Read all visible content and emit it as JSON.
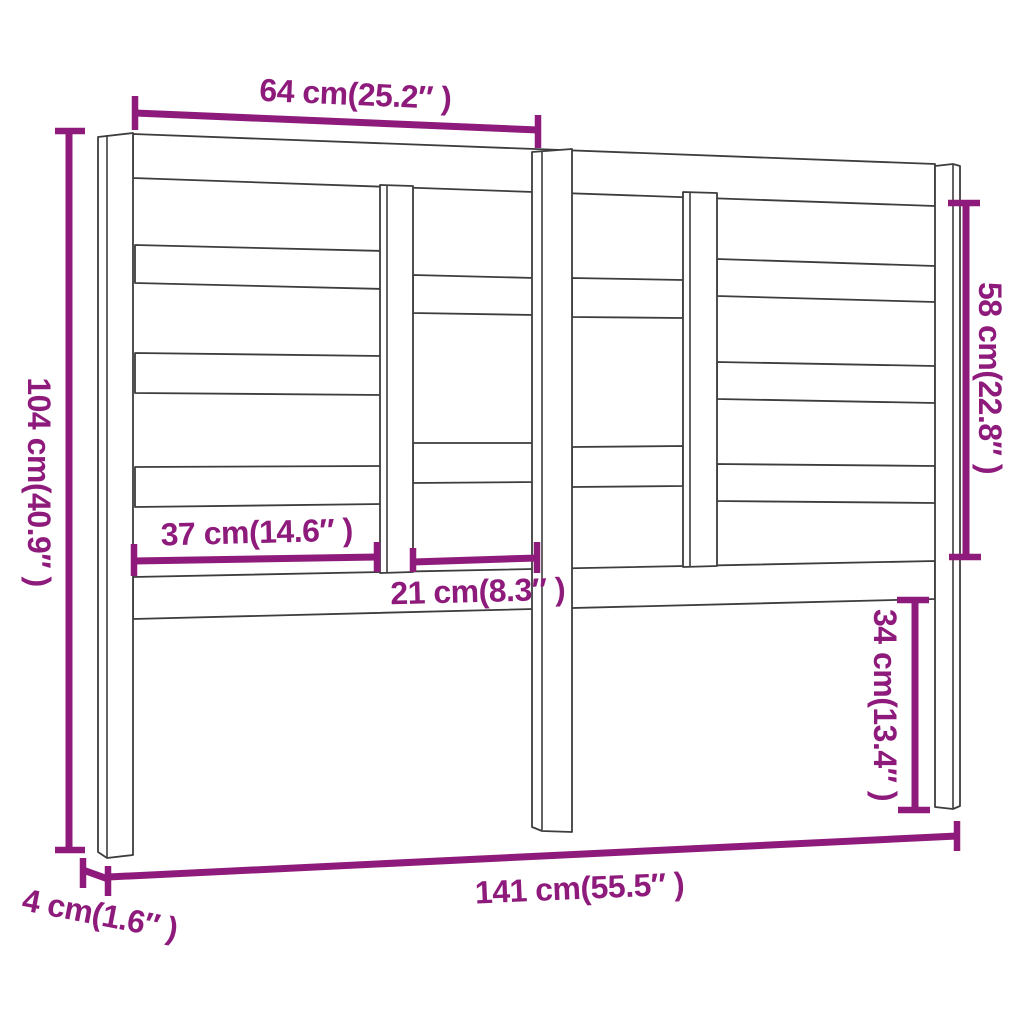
{
  "page": {
    "background": "#ffffff",
    "kind": "furniture-dimension-diagram",
    "subject": "slatted-headboard-line-drawing"
  },
  "colors": {
    "dimension_annotation": "#8E1B7C",
    "drawing_outline": "#3d3d3d"
  },
  "dimensions": {
    "items": [
      {
        "id": "top-section-width",
        "label": "64 cm(25.2″ )",
        "cm": 64,
        "inches": 25.2
      },
      {
        "id": "overall-height",
        "label": "104 cm(40.9″ )",
        "cm": 104,
        "inches": 40.9
      },
      {
        "id": "right-panel-height",
        "label": "58 cm(22.8″ )",
        "cm": 58,
        "inches": 22.8
      },
      {
        "id": "left-opening-width",
        "label": "37 cm(14.6″ )",
        "cm": 37,
        "inches": 14.6
      },
      {
        "id": "center-opening-width",
        "label": "21 cm(8.3″ )",
        "cm": 21,
        "inches": 8.3
      },
      {
        "id": "right-leg-height",
        "label": "34 cm(13.4″ )",
        "cm": 34,
        "inches": 13.4
      },
      {
        "id": "overall-width",
        "label": "141 cm(55.5″ )",
        "cm": 141,
        "inches": 55.5
      },
      {
        "id": "depth",
        "label": "4 cm(1.6″ )",
        "cm": 4,
        "inches": 1.6
      }
    ]
  }
}
